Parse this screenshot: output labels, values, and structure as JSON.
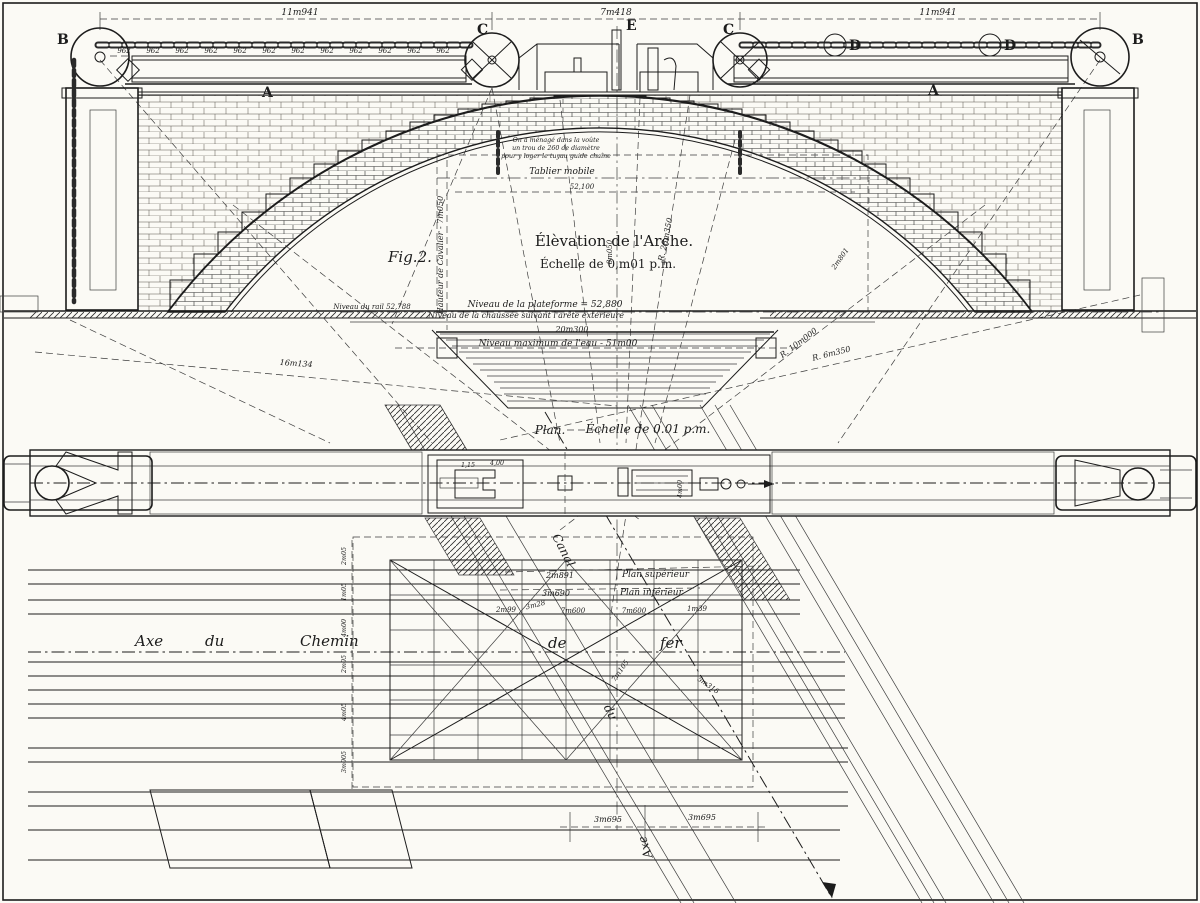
{
  "elevation": {
    "fig_label": "Fig.2.",
    "title": "Élèvation de l'Arche.",
    "scale": "Échelle de 0,m01 p.m.",
    "dim_left": "11m941",
    "dim_center": "7m418",
    "dim_right": "11m941",
    "chain_value": "962",
    "letter_a": "A",
    "letter_b": "B",
    "letter_c": "C",
    "letter_d": "D",
    "letter_e": "E",
    "note_1": "On a ménagé dans la voûte",
    "note_2": "un trou de 260 de diamètre",
    "note_3": "pour y loger le tuyau guide chaîne",
    "tablier_label": "Tablier mobile",
    "tablier_level": "52,100",
    "cavalier_label": "Hauteur de Cavalier - 7m050",
    "axis_dim": "8m050",
    "niveau_rail": "Niveau du rail 52,788",
    "niveau_plateforme": "Niveau de la plateforme = 52,880",
    "niveau_chaussee": "Niveau de la chaussée suivant l'arête extérieure",
    "niveau_20300": "20m300",
    "niveau_eau": "Niveau maximum de l'eau - 51m00",
    "r_intrados": "R. 28m350",
    "r_10000": "R. 10m000",
    "r_6350": "R. 6m350",
    "dim_16134": "16m134",
    "dim_2801": "2m801"
  },
  "plan": {
    "title": "Plan.",
    "scale": "Échelle de 0.01 p.m.",
    "dim_115": "1,15",
    "dim_400": "4,00",
    "dim_400r": "4m00"
  },
  "foundation": {
    "axe_word": "Axe",
    "du_word": "du",
    "chemin_word": "Chemin",
    "de_word": "de",
    "fer_word": "fer",
    "canal_word": "Canal",
    "canal_du": "du",
    "canal_axe": "Axe",
    "plan_sup": "Plan supérieur",
    "plan_sup_dim": "2m891",
    "plan_inf": "Plan inférieur",
    "plan_inf_dim": "3m690",
    "row_a": "2m99",
    "row_b": "3m28",
    "row_c": "7m600",
    "row_d": "7m600",
    "row_e": "1m39",
    "bottom_a": "3m695",
    "bottom_b": "3m695",
    "col_1": "2m05",
    "col_2": "1m05",
    "col_3": "4m00",
    "col_4": "2m05",
    "col_5": "4m05",
    "col_6": "3m005",
    "diag_a": "7m105",
    "diag_b": "5m316"
  }
}
